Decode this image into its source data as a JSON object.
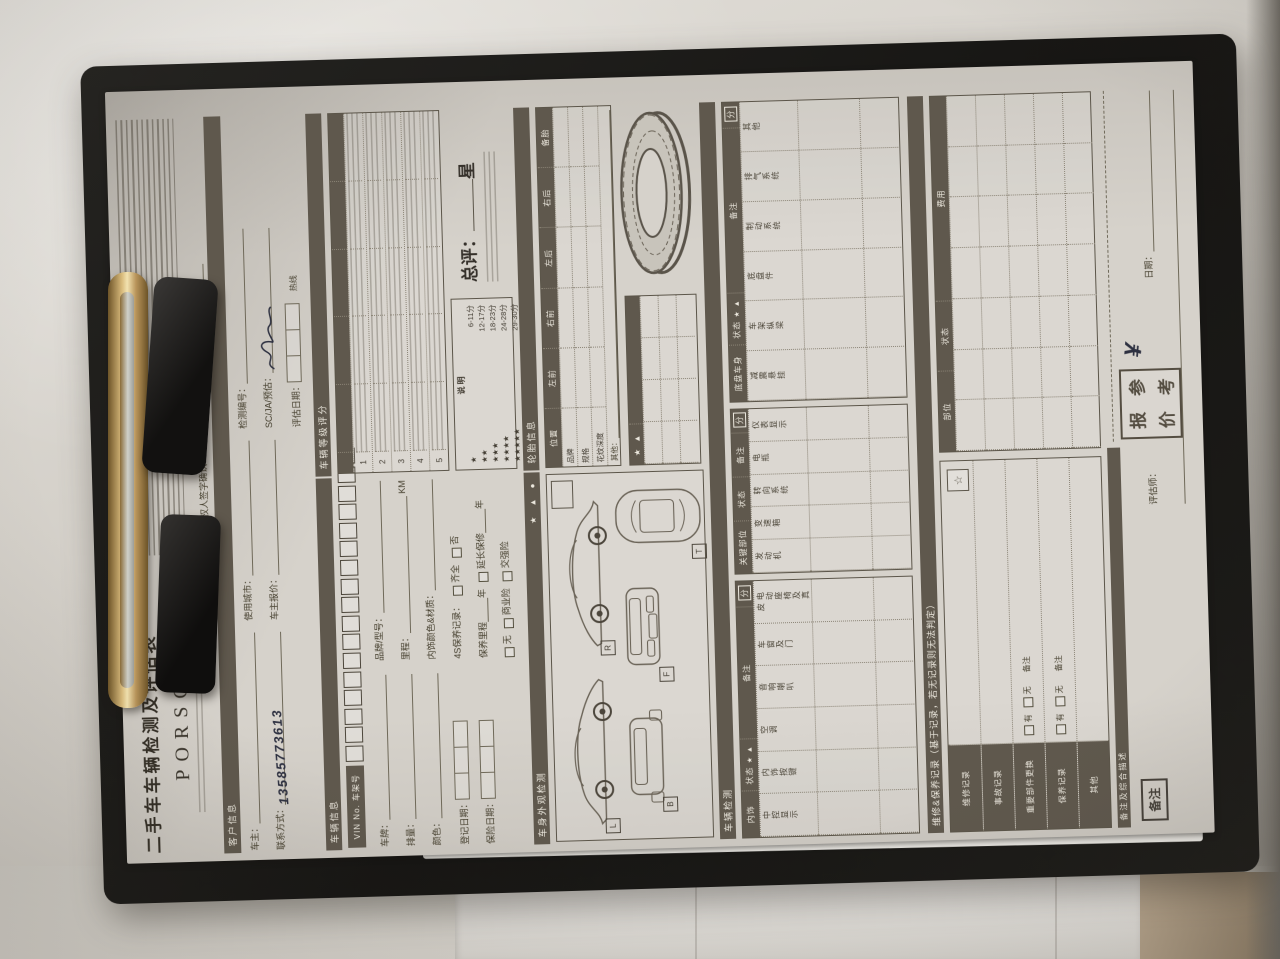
{
  "colors": {
    "paper": "#d6d2cb",
    "band": "#5f584d",
    "ink": "#423c32",
    "handwriting": "#2d3040",
    "board": "#161513",
    "clip_brass": "#d9bb7c"
  },
  "form": {
    "title": "二手车车辆检测及评估表",
    "brand": {
      "wordmark": "PORSCHE"
    },
    "header": {
      "sign_confirm": "车主或授权人签字确认：",
      "date_label": "日期："
    },
    "customer": {
      "band": "客户信息",
      "owner": "车主：",
      "contact": "联系方式：",
      "contact_value": "13585773613",
      "city": "使用城市：",
      "owner_price": "车主报价：",
      "report_no": "检测编号：",
      "scja": "SC/JA/预估：",
      "eval_date": "评估日期：",
      "hotline": "热线"
    },
    "vehicle": {
      "band": "车辆信息",
      "vin_label": "VIN No. 车架号",
      "plate": "车牌：",
      "brand_model": "品牌/型号：",
      "displacement": "排量：",
      "mileage": "里程：",
      "mileage_unit": "KM",
      "color": "颜色：",
      "interior": "内饰颜色&材质：",
      "reg_date": "登记日期：",
      "service_record": "4S保养记录：",
      "opt_complete": "齐全",
      "opt_no": "否",
      "insure_date": "保险日期：",
      "service_mileage": "保养里程",
      "year_unit": "年",
      "ext_warranty": "延长保修",
      "opt_none": "无",
      "opt_commercial": "商业险",
      "opt_compulsory": "交强险"
    },
    "grade": {
      "band": "车辆等级评分",
      "rows": [
        "1",
        "2",
        "3",
        "4",
        "5"
      ],
      "legend_title": "说明",
      "legend": [
        {
          "stars": "★",
          "range": "6-11分"
        },
        {
          "stars": "★★",
          "range": "12-17分"
        },
        {
          "stars": "★★★",
          "range": "18-23分"
        },
        {
          "stars": "★★★★",
          "range": "24-28分"
        },
        {
          "stars": "★★★★★",
          "range": "29-30分"
        }
      ],
      "overall_label": "总评：",
      "overall_unit": "星"
    },
    "exterior": {
      "band": "车身外观检测",
      "tire_band": "轮胎信息",
      "symbols": "★ ▲ ●",
      "views": [
        "L",
        "R",
        "B",
        "F",
        "T"
      ],
      "tire": {
        "headers": [
          "位置",
          "左前",
          "右前",
          "左后",
          "右后",
          "备胎"
        ],
        "rows": [
          "品牌",
          "规格",
          "花纹深度"
        ],
        "other": "其他："
      }
    },
    "inspection": {
      "band": "车辆检测",
      "status_label": "状态",
      "status_syms": "★ ▲",
      "remark_label": "备注",
      "score_label": "分",
      "groups": [
        {
          "name": "内饰",
          "items": [
            "中控显示",
            "内饰按键",
            "空调",
            "音响喇叭",
            "车窗及门",
            "电动座椅及真皮"
          ]
        },
        {
          "name": "关键部位",
          "items": [
            "发动机",
            "变速箱",
            "转向系统",
            "电瓶",
            "仪表显示"
          ]
        },
        {
          "name": "底盘车身",
          "items": [
            "减震悬挂",
            "车架纵梁",
            "底盘件",
            "制动系统",
            "排气系统",
            "其他"
          ]
        }
      ]
    },
    "maintenance": {
      "band": "维修&保养记录（基于记录，若无记录则无法判定）",
      "rows": [
        "维修记录",
        "事故记录",
        "重要部件更换",
        "保养记录",
        "其他"
      ],
      "has": "有",
      "none": "无",
      "remark": "备注",
      "cost_headers": [
        "部位",
        "状态",
        "费用"
      ]
    },
    "footer": {
      "summary_band": "备注及综合描述",
      "remark_label": "备注",
      "appraiser": "评估师：",
      "date_label": "日期：",
      "stamp_text": "报价参考",
      "stamp_chars": [
        "报",
        "参",
        "价",
        "考"
      ],
      "currency": "¥"
    }
  }
}
